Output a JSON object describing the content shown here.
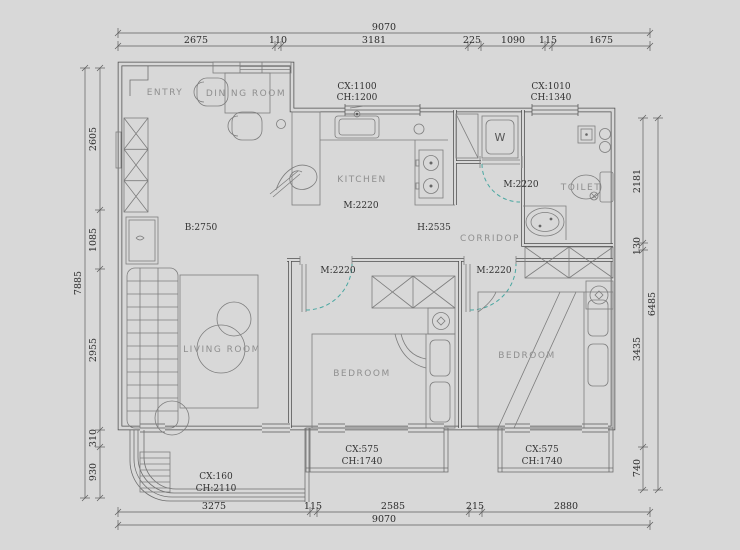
{
  "plan": {
    "rooms": {
      "entry": "ENTRY",
      "dining": "DINING ROOM",
      "kitchen": "KITCHEN",
      "corridor": "CORRIDOP",
      "toilet": "TOILET",
      "living": "LIVING ROOM",
      "bedroom1": "BEDROOM",
      "bedroom2": "BEDROOM"
    },
    "labels": {
      "win_top_mid_cx": "CX:1100",
      "win_top_mid_ch": "CH:1200",
      "win_top_right_cx": "CX:1010",
      "win_top_right_ch": "CH:1340",
      "kitchen_m": "M:2220",
      "bath_m": "M:2220",
      "bed1_m": "M:2220",
      "bed2_m": "M:2220",
      "living_b": "B:2750",
      "hall_h": "H:2535",
      "washer": "W",
      "bal_left_cx": "CX:160",
      "bal_left_ch": "CH:2110",
      "bal_mid_cx": "CX:575",
      "bal_mid_ch": "CH:1740",
      "bal_right_cx": "CX:575",
      "bal_right_ch": "CH:1740"
    },
    "dims": {
      "top": {
        "total": "9070",
        "segs": [
          "2675",
          "110",
          "3181",
          "225",
          "1090",
          "115",
          "1675"
        ]
      },
      "bottom": {
        "total": "9070",
        "segs": [
          "3275",
          "115",
          "2585",
          "215",
          "2880"
        ]
      },
      "left": {
        "total": "7885",
        "segs": [
          "2605",
          "1085",
          "2955",
          "310",
          "930"
        ]
      },
      "right": {
        "total": "6485",
        "segs": [
          "2181",
          "130",
          "3435",
          "740"
        ]
      }
    },
    "colors": {
      "background": "#d8d8d8",
      "wall_line": "#4d4d4d",
      "door_arc": "#49a7a1",
      "dim_text": "#2b2b2b",
      "room_text": "#8f8f8f"
    }
  }
}
